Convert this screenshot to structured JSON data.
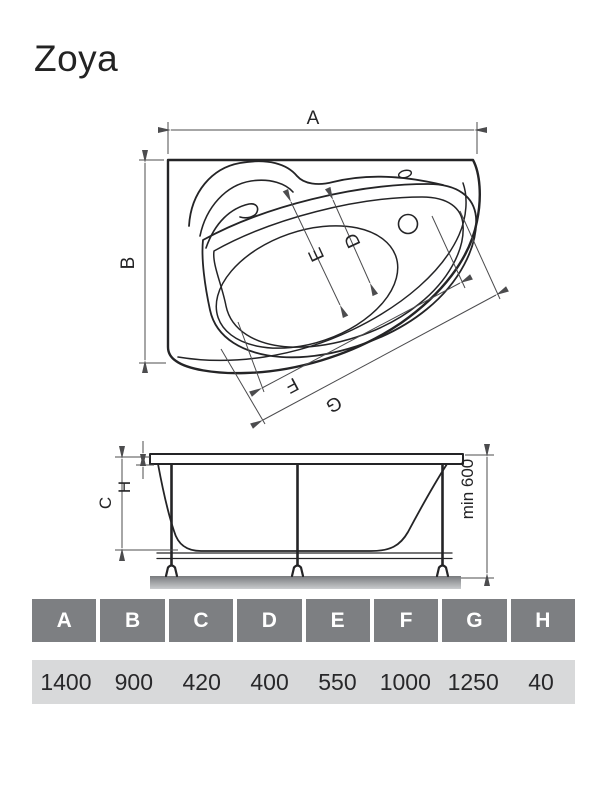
{
  "title": "Zoya",
  "drawing": {
    "top_view": {
      "dim_a": "A",
      "dim_b": "B",
      "dim_d": "D",
      "dim_e": "E",
      "dim_f": "F",
      "dim_g": "G"
    },
    "side_view": {
      "dim_c": "C",
      "dim_h": "H",
      "min_height": "min 600"
    }
  },
  "table": {
    "headers": [
      "A",
      "B",
      "C",
      "D",
      "E",
      "F",
      "G",
      "H"
    ],
    "values": [
      "1400",
      "900",
      "420",
      "400",
      "550",
      "1000",
      "1250",
      "40"
    ]
  },
  "colors": {
    "line": "#242426",
    "dimension_line": "#4c4c4e",
    "header_bg": "#7d7f82",
    "header_text": "#ffffff",
    "value_row_bg": "#d8d9da",
    "ground_top": "#797b7e",
    "ground_bottom": "#caccce"
  }
}
